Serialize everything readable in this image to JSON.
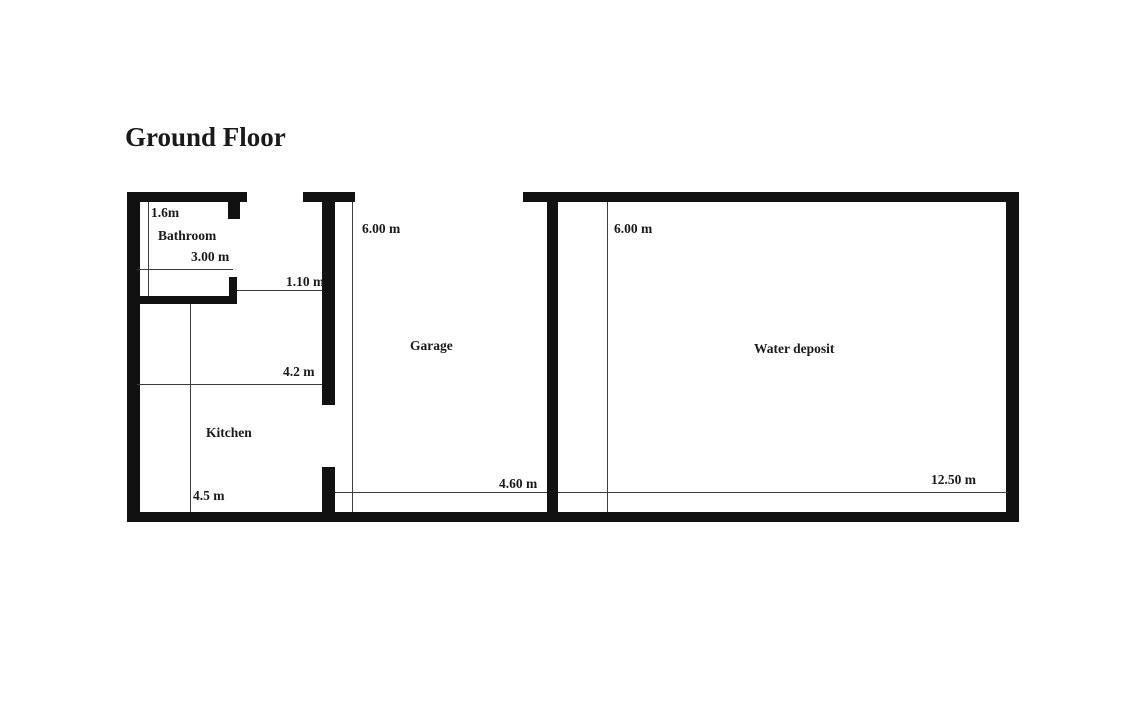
{
  "title": "Ground Floor",
  "rooms": {
    "bathroom": "Bathroom",
    "kitchen": "Kitchen",
    "garage": "Garage",
    "water_deposit": "Water deposit"
  },
  "dimensions": {
    "bathroom_depth": "1.6m",
    "bathroom_width": "3.00 m",
    "door_opening": "1.10 m",
    "kitchen_width": "4.2 m",
    "kitchen_depth": "4.5 m",
    "garage_depth": "6.00 m",
    "garage_width": "4.60 m",
    "water_deposit_depth": "6.00 m",
    "water_deposit_width": "12.50 m"
  },
  "colors": {
    "background": "#ffffff",
    "wall": "#111111",
    "dimension_line": "#3c3c3c",
    "text": "#1a1a1a"
  }
}
